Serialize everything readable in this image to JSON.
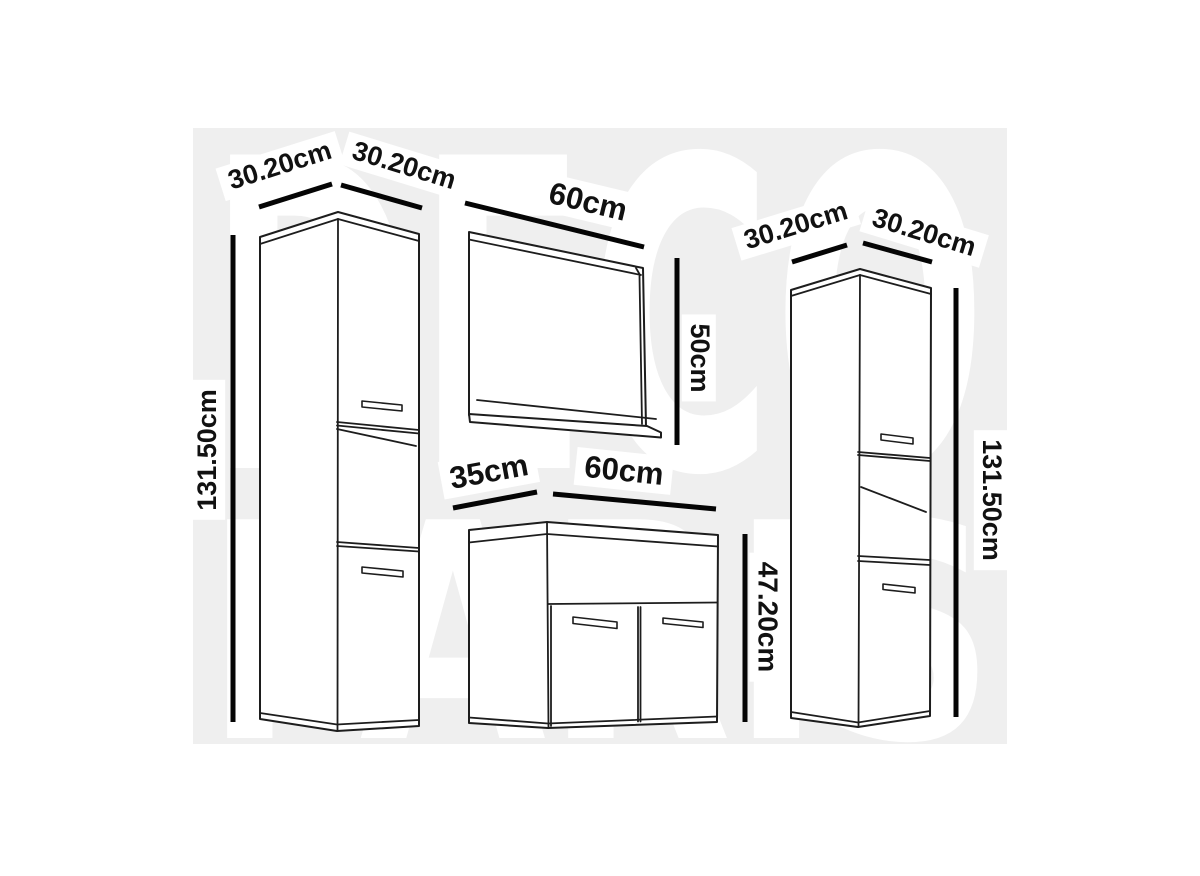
{
  "title": "Bathroom furniture set dimension diagram",
  "watermark": {
    "line1": "DECO",
    "line2": "PARIS"
  },
  "pieces": {
    "left_cabinet": {
      "name": "tall side cabinet (left)",
      "depth": "30.20cm",
      "width": "30.20cm",
      "height": "131.50cm"
    },
    "mirror": {
      "name": "mirror with shelf",
      "width": "60cm",
      "height": "50cm"
    },
    "vanity": {
      "name": "vanity basin unit",
      "depth": "35cm",
      "width": "60cm",
      "height": "47.20cm"
    },
    "right_cabinet": {
      "name": "tall side cabinet (right)",
      "depth": "30.20cm",
      "width": "30.20cm",
      "height": "131.50cm"
    }
  },
  "colors": {
    "background": "#ffffff",
    "watermark_panel": "#efefef",
    "watermark_text": "#ffffff",
    "outline": "#1d1d1d",
    "dimension_line": "#050505",
    "label_text": "#111111",
    "label_halo": "#ffffff"
  }
}
